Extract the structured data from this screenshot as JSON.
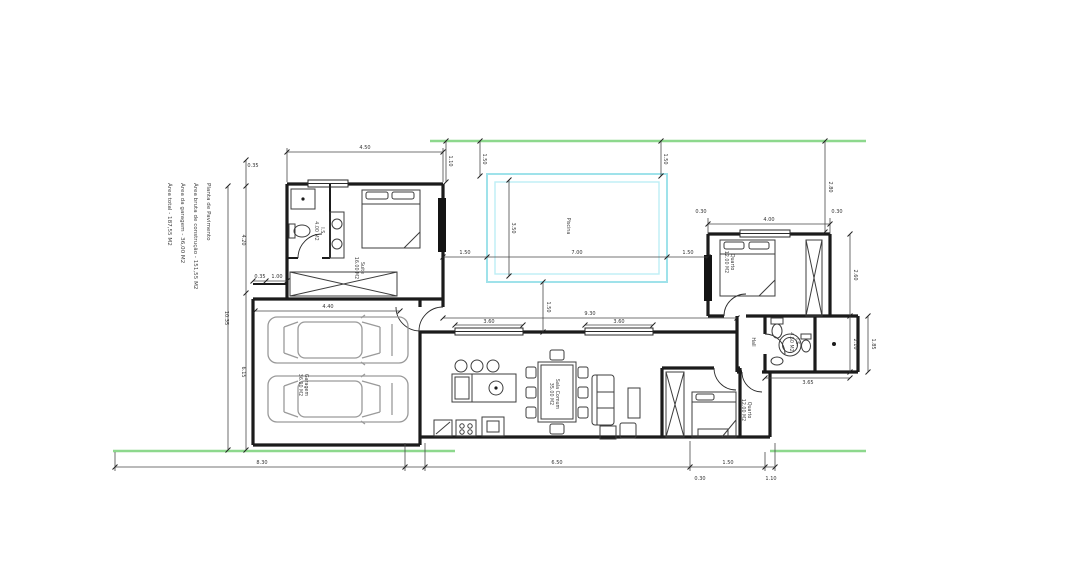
{
  "document": {
    "info_lines": [
      "Planta de Pavimento",
      "Área bruta de construção    - 151,55 M2",
      "Área da garagem             - 36,00 M2",
      "Área total                  - 187,55 M2"
    ]
  },
  "rooms": {
    "suite": {
      "name": "Suite",
      "area": "16.00 M2"
    },
    "suite_bath": {
      "name": "I.S.",
      "area": "4.00 M2"
    },
    "garage": {
      "name": "Garagem",
      "area": "36.00 M2"
    },
    "pool": {
      "name": "Piscina"
    },
    "bedroom2": {
      "name": "Quarto",
      "area": "12.00 M2"
    },
    "bath2": {
      "name": "I.S.",
      "area": "4.50 M2"
    },
    "hall": {
      "name": "Hall"
    },
    "living": {
      "name": "Sala Comum",
      "area": "35.00 M2"
    },
    "bedroom3": {
      "name": "Quarto",
      "area": "12.00 M2"
    }
  },
  "dims": {
    "left_total": "10.35",
    "left_upper": "4.20",
    "left_lower": "6.15",
    "left_top_offset": "0.35",
    "suite_width": "4.50",
    "suite_step_a": "0.35",
    "suite_step_b": "1.00",
    "garage_width": "4.40",
    "pool_offset_left": "1.10",
    "pool_top_left": "1.50",
    "pool_top_right": "1.50",
    "pool_width": "7.00",
    "pool_height": "3.50",
    "pool_left_gap": "1.50",
    "pool_right_gap": "1.50",
    "pool_bottom_gap": "1.50",
    "terrace_width": "9.30",
    "window_a": "3.60",
    "window_b": "3.60",
    "bed2_width": "4.00",
    "bed2_offset_a": "0.30",
    "bed2_offset_b": "0.30",
    "right_top": "2.80",
    "right_bed2": "2.60",
    "right_bath": "2.10",
    "right_side": "1.85",
    "bath_width": "3.65",
    "bottom_a": "8.30",
    "bottom_b": "6.50",
    "bottom_c": "1.50",
    "bottom_d": "0.30",
    "bottom_e": "1.10"
  },
  "colors": {
    "boundary_green": "#8dd88d",
    "pool_cyan": "#9fe2ea",
    "wall_black": "#1b1b1b",
    "car_gray": "#9a9a9a",
    "background": "#ffffff"
  }
}
